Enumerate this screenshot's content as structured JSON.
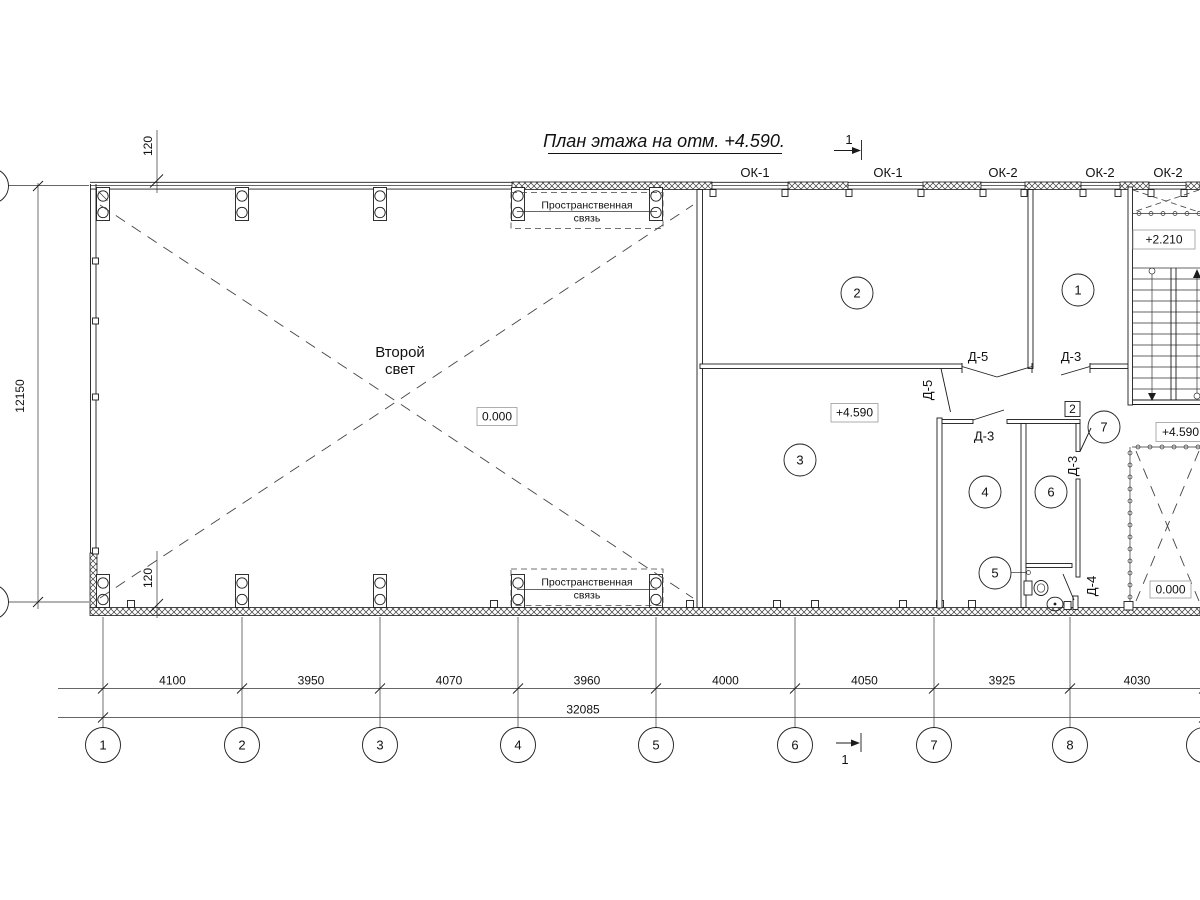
{
  "title": "План этажа на отм. +4.590.",
  "section_mark_top": "1",
  "section_mark_bottom": "1",
  "windows": [
    "ОК-1",
    "ОК-1",
    "ОК-2",
    "ОК-2",
    "ОК-2"
  ],
  "doors": {
    "d5_double": "Д-5",
    "d5_single": "Д-5",
    "d3_hall": "Д-3",
    "d3_room4": "Д-3",
    "d3_room6": "Д-3",
    "d4_wc": "Д-4"
  },
  "rooms": [
    "1",
    "2",
    "3",
    "4",
    "5",
    "6",
    "7"
  ],
  "partition_tag": "2",
  "elevations": {
    "hall": "0.000",
    "room3": "+4.590",
    "stair_landing": "+2.210",
    "stair_exit": "+4.590",
    "void": "0.000"
  },
  "notes": {
    "second_light_1": "Второй",
    "second_light_2": "свет",
    "spatial_tie_1": "Пространственная",
    "spatial_tie_2": "связь"
  },
  "dimensions": {
    "segments": [
      "4100",
      "3950",
      "4070",
      "3960",
      "4000",
      "4050",
      "3925",
      "4030"
    ],
    "total": "32085",
    "height": "12150",
    "offset": "120"
  },
  "axes": [
    "1",
    "2",
    "3",
    "4",
    "5",
    "6",
    "7",
    "8"
  ]
}
